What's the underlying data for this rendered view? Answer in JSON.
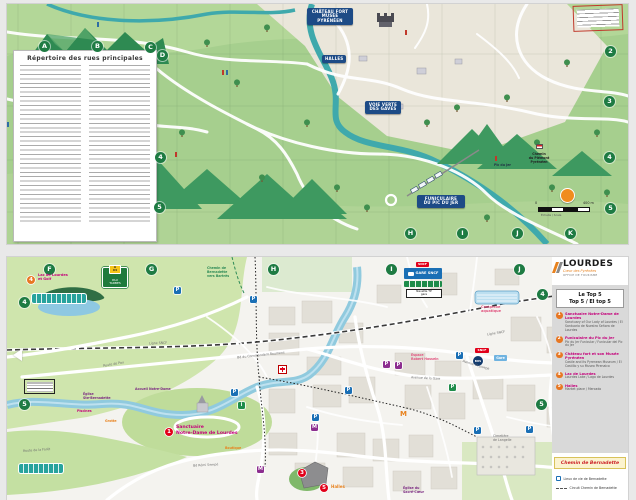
{
  "top_map": {
    "index_title": "Répertoire des rues principales",
    "banners": {
      "chateau": "Château Fort\nMusée Pyrénéen",
      "halles": "Halles",
      "voie_verte": "Voie Verte\ndes Gaves",
      "funiculaire": "Funiculaire\ndu Pic du Jer"
    },
    "labels": {
      "piemont": "Chemin\ndu Piémont\nPyrénéen",
      "pic": "Pic du Jer"
    },
    "grid": {
      "top": [
        "A",
        "B",
        "C",
        "D"
      ],
      "right": [
        "2",
        "3",
        "4",
        "5"
      ],
      "mid": [
        "4",
        "5"
      ],
      "bottom": [
        "H",
        "I",
        "J",
        "K"
      ]
    },
    "scale": {
      "zero": "0",
      "end": "400 m",
      "caption": "Échelle / Scale"
    }
  },
  "bottom_map": {
    "grid": {
      "top": [
        "F",
        "G",
        "H",
        "I",
        "J"
      ],
      "left": [
        "4",
        "5"
      ],
      "right": [
        "4",
        "5"
      ]
    },
    "markers": {
      "m1": "1",
      "m3": "3",
      "m4": "4",
      "m5": "5"
    },
    "labels": {
      "lac": "Lac de Lourdes\net Golf",
      "sanctuaire": "Sanctuaire\nNotre-Dame de Lourdes",
      "accueil": "Accueil Notre-Dame",
      "bartres": "Chemin de\nBernadette\nvers Bartrès",
      "grotte": "Grotte",
      "piscines": "Piscines",
      "boutique": "Boutique",
      "halles": "Halles",
      "sacre_coeur": "Église du\nSacré-Cœur",
      "ste_bernadette": "Église\nSte-Bernadette",
      "cimetiere": "Cimetière\nde Langelle",
      "complexe": "Complexe\naquatique",
      "hossein": "Espace\nRobert Hossein",
      "navette": "Navette TP\ngare",
      "sncf": "SNCF",
      "bus": "BUS",
      "gare": "Gare",
      "gare_sncf": "GARE SNCF",
      "museum_m": "M"
    },
    "streets": {
      "ligne1": "Ligne SNCF",
      "ligne2": "Ligne SNCF",
      "commandant": "Bd du Commandant Roumens",
      "gare": "Avenue de la Gare",
      "joseph": "Avenue St-Joseph",
      "foret": "Route de la Forêt",
      "pau": "Route de Pau",
      "sempe": "Bd Rémi Sempé"
    },
    "a64": {
      "chip": "A 64",
      "text": "PAU\nTARBES"
    },
    "panel": {
      "logo": {
        "name": "LOURDES",
        "tag": "Cœur des Pyrénées",
        "sub": "Office de Tourisme"
      },
      "top5_title_fr": "Le Top 5",
      "top5_title_intl": "Top 5 / El top 5",
      "items": [
        {
          "num": "1",
          "fr": "Sanctuaire Notre-Dame de Lourdes",
          "tr": "Sanctuary of Our Lady of Lourdes / El Santuario de Nuestra Señora de Lourdes"
        },
        {
          "num": "2",
          "fr": "Funiculaire du Pic du Jer",
          "tr": "Pic du Jer Funicular / Funicular del Pic du Jer"
        },
        {
          "num": "3",
          "fr": "Château fort et son Musée Pyrénéen",
          "tr": "Castle and its Pyrenean Museum / El Castillo y su Museo Pirenaico"
        },
        {
          "num": "4",
          "fr": "Lac de Lourdes",
          "tr": "Lourdes Lake / Lago de Lourdes"
        },
        {
          "num": "5",
          "fr": "Halles",
          "tr": "Market place / Mercado"
        }
      ],
      "chemin_title": "Chemin de Bernadette",
      "legend": [
        {
          "label": "Lieux de vie de Bernadette"
        },
        {
          "label": "Circuit Chemin de Bernadette"
        }
      ]
    }
  }
}
